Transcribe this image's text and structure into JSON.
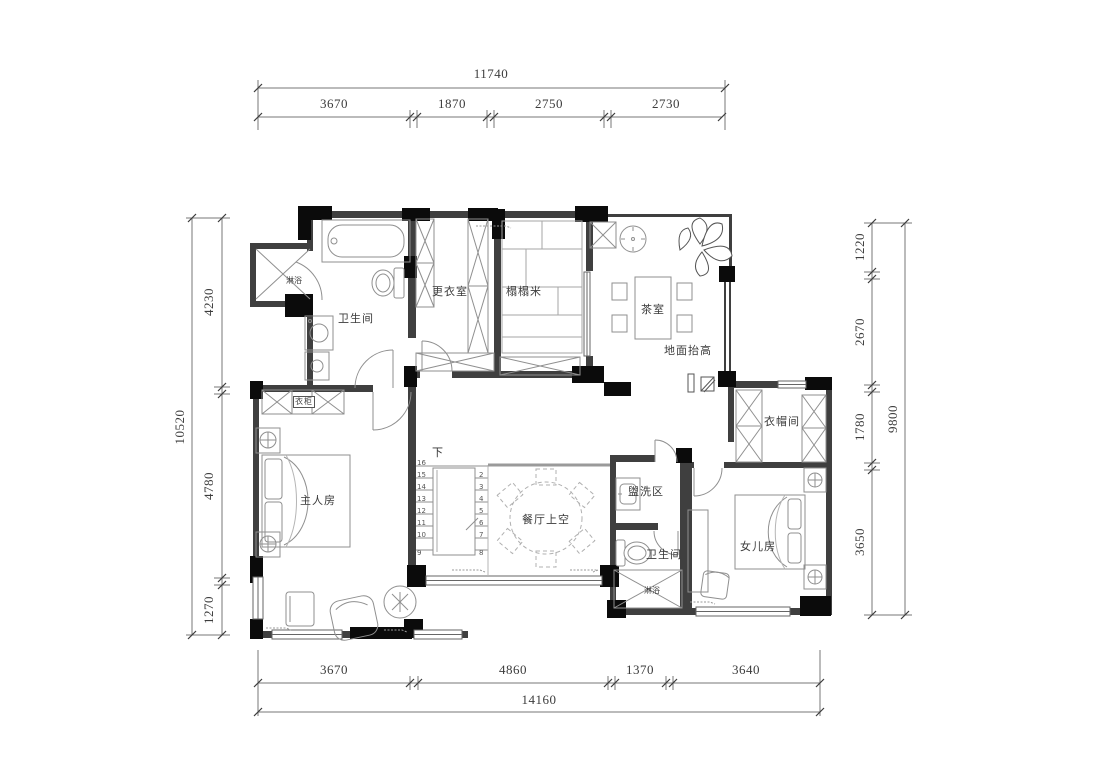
{
  "drawing": {
    "dims": {
      "top": {
        "total": "11740",
        "segments": [
          "3670",
          "1870",
          "2750",
          "2730"
        ]
      },
      "bottom": {
        "total": "14160",
        "segments": [
          "3670",
          "4860",
          "1370",
          "3640"
        ]
      },
      "left": {
        "total": "10520",
        "segments": [
          "4230",
          "4780",
          "1270"
        ]
      },
      "right": {
        "total": "9800",
        "segments": [
          "1220",
          "2670",
          "1780",
          "3650"
        ]
      }
    },
    "labels": {
      "bathroom_top": "卫生间",
      "shower_top": "淋浴",
      "dressing_room": "更衣室",
      "tatami": "榻榻米",
      "tea_room": "茶室",
      "floor_raised": "地面抬高",
      "cloakroom": "衣帽间",
      "wardrobe": "衣柜",
      "master_bedroom": "主人房",
      "dining_void": "餐厅上空",
      "wash_area": "盥洗区",
      "bathroom_2": "卫生间",
      "shower_2": "淋浴",
      "daughter_room": "女儿房",
      "stair_down": "下"
    },
    "stairs": {
      "left": [
        "16",
        "15",
        "14",
        "13",
        "12",
        "11",
        "10",
        "9"
      ],
      "right": [
        "2",
        "3",
        "4",
        "5",
        "6",
        "7",
        "8"
      ]
    },
    "colors": {
      "wall": "#3f3f3f",
      "post": "#0b0b0b",
      "furniture": "#8f8f8f",
      "dimension_text": "#3c3c3c"
    }
  }
}
